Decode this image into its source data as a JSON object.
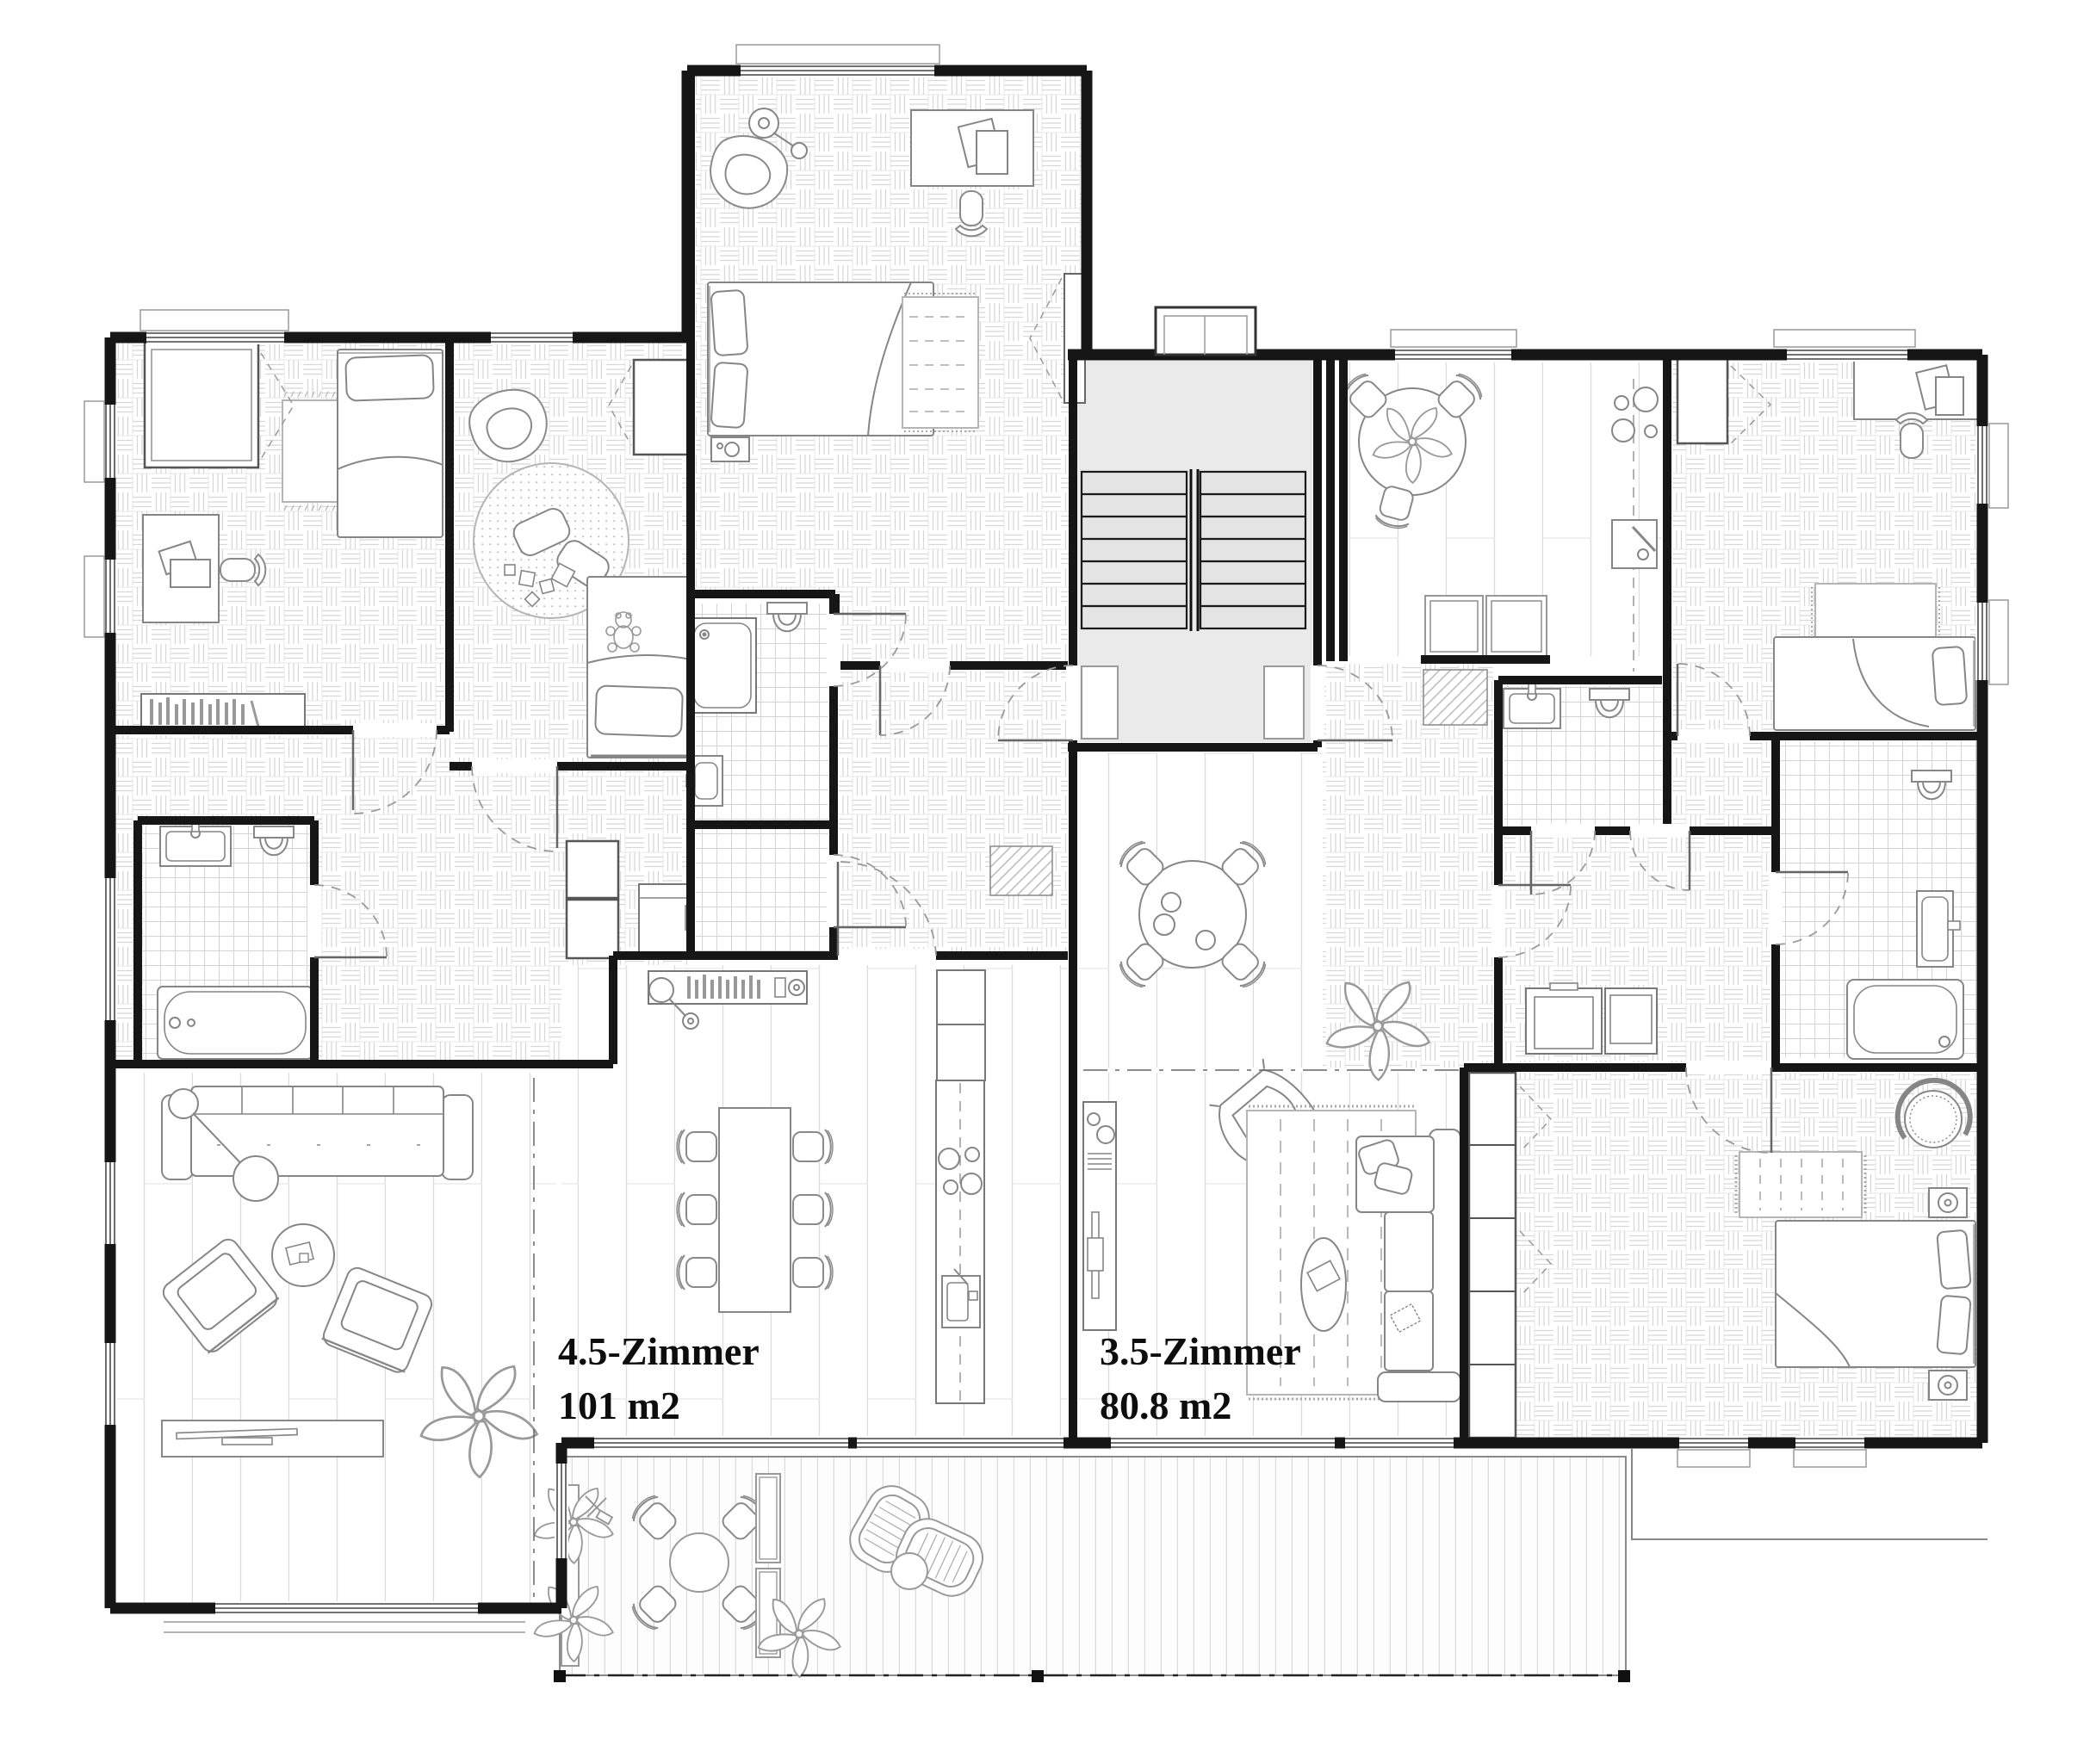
{
  "plan": {
    "apartments": [
      {
        "name": "left",
        "label": "4.5-Zimmer",
        "area": "101 m2"
      },
      {
        "name": "right",
        "label": "3.5-Zimmer",
        "area": "80.8 m2"
      }
    ],
    "stairwell": {
      "flights": 2,
      "treads_per_flight": 7
    },
    "colors": {
      "wall": "#161616",
      "furniture_line": "#868686",
      "floor_line": "#d7d7d7",
      "stair_fill": "#eaeaea",
      "paper": "#ffffff",
      "label_text": "#0d0d0d"
    }
  }
}
